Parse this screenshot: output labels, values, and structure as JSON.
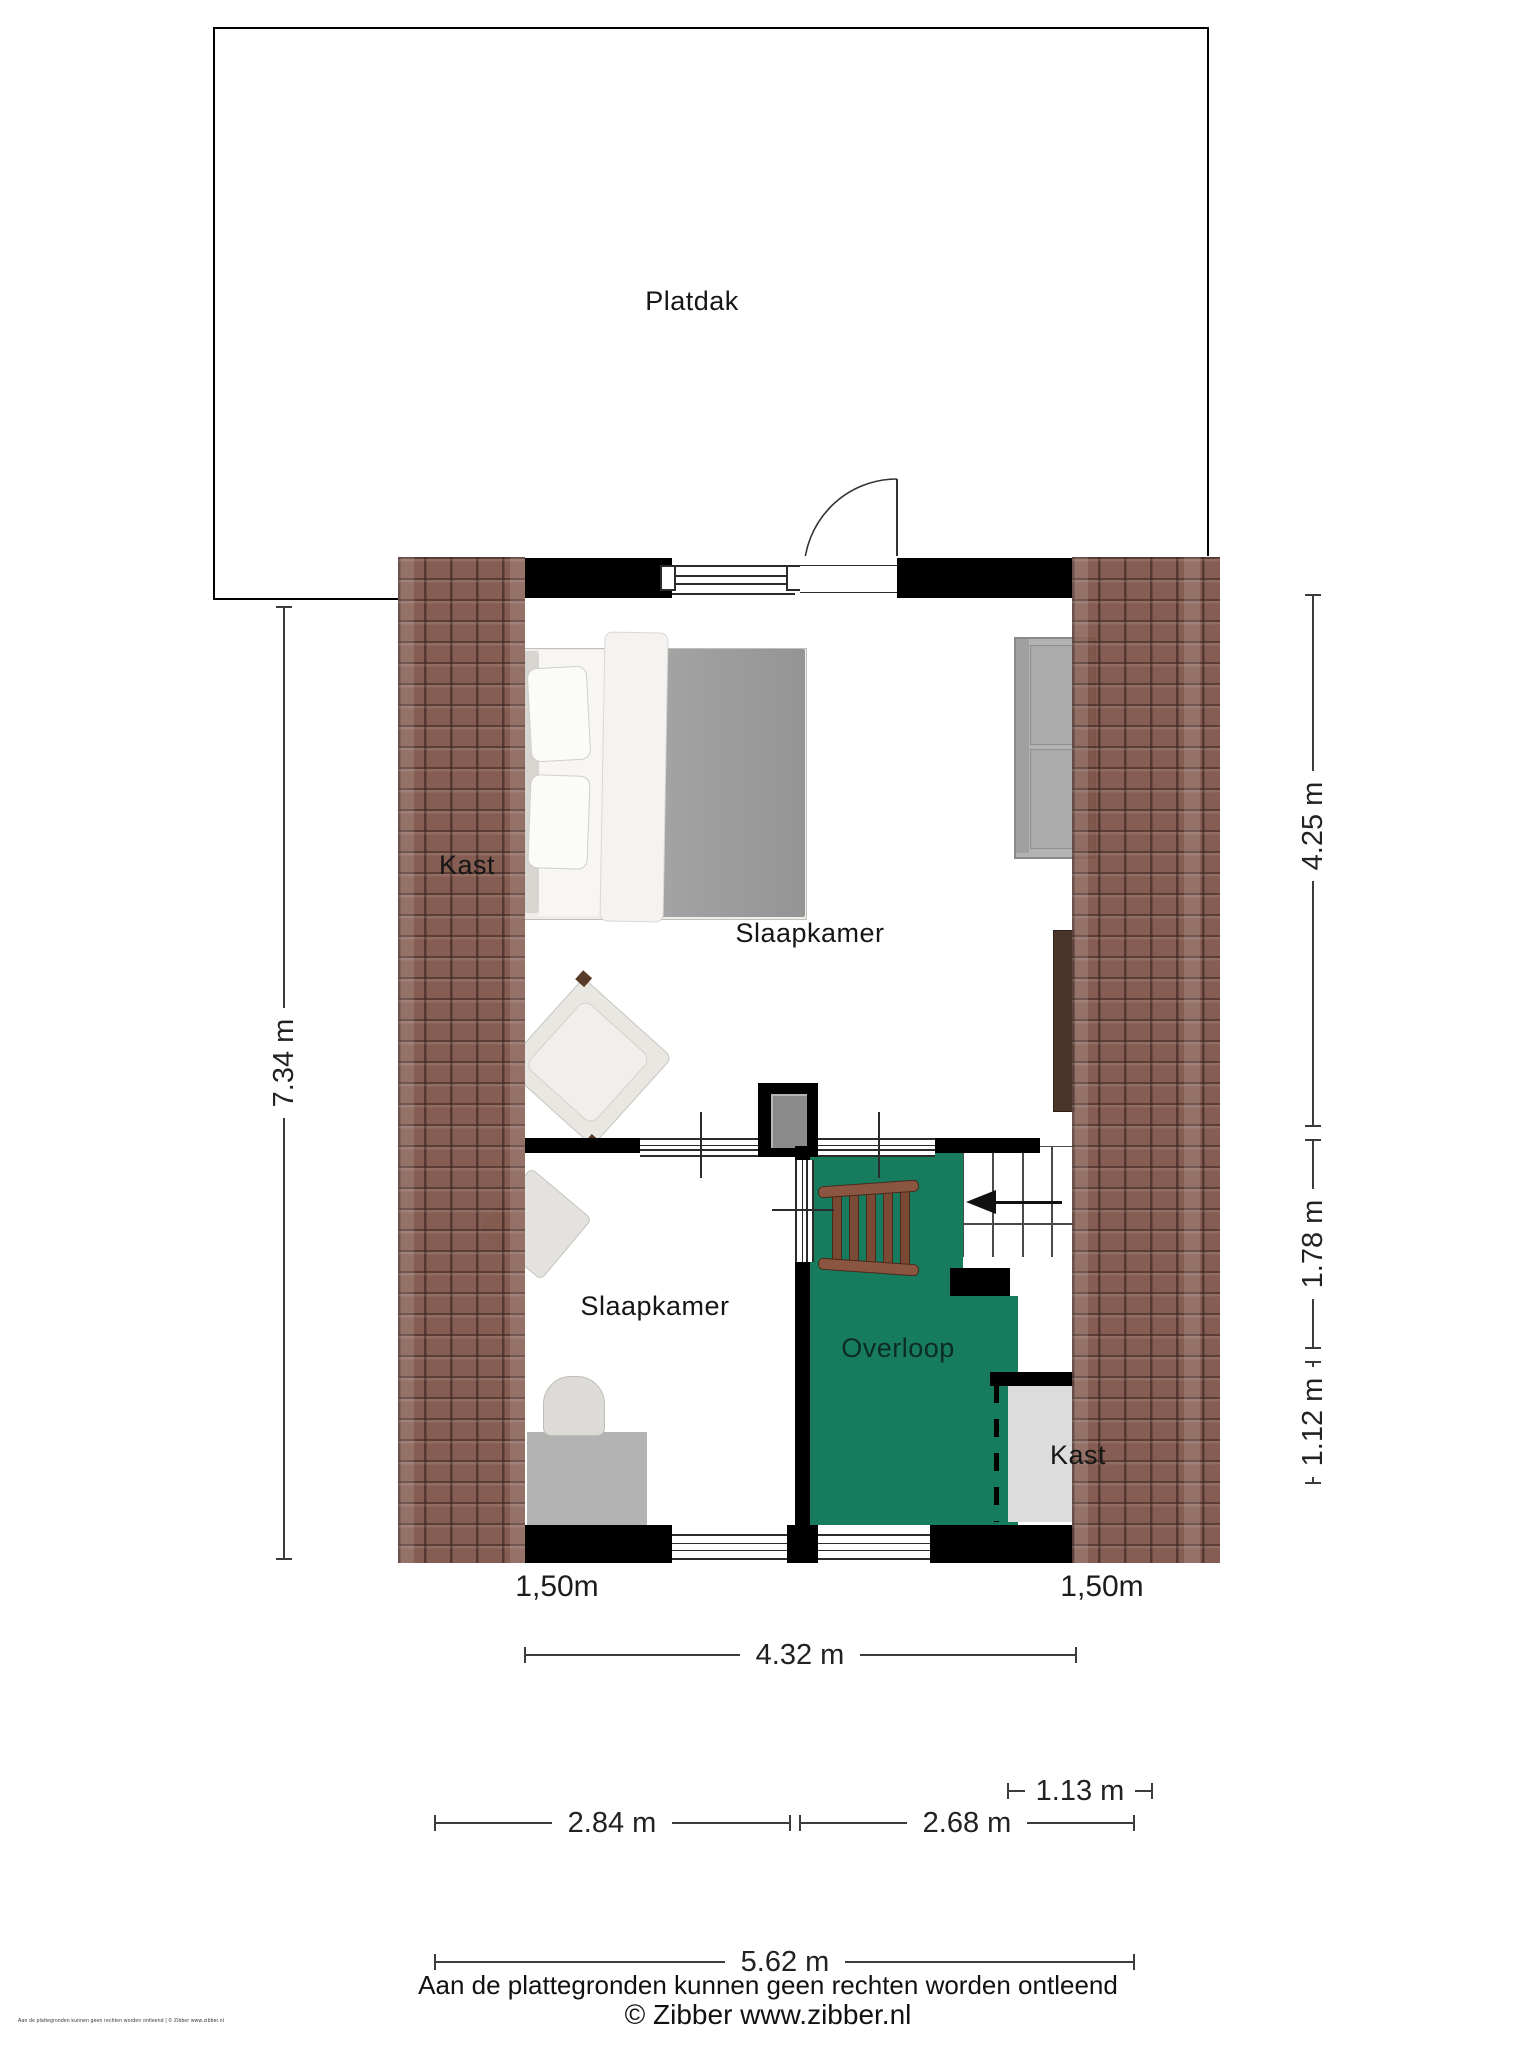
{
  "rooms": {
    "platdak": "Platdak",
    "slaapkamer_top": "Slaapkamer",
    "slaapkamer_bottom": "Slaapkamer",
    "overloop": "Overloop",
    "kast_left": "Kast",
    "kast_right": "Kast"
  },
  "dims": {
    "total_height": "7.34 m",
    "upper_height": "4.25 m",
    "middle_height": "1.78 m",
    "lower_height": "1.12 m",
    "knee_left": "1,50m",
    "knee_right": "1,50m",
    "inner_width": "4.32 m",
    "closet_width": "1.13 m",
    "room_left_width": "2.84 m",
    "room_right_width": "2.68 m",
    "total_width": "5.62 m"
  },
  "footer": {
    "disclaimer": "Aan de plattegronden kunnen geen rechten worden ontleend",
    "copyright": "© Zibber www.zibber.nl",
    "micro": "Aan de plattegronden kunnen geen rechten worden ontleend | © Zibber www.zibber.nl"
  },
  "colors": {
    "overloop_green": "#177C5E",
    "roof_tile_brown": "#7D5145",
    "wall_black": "#000000",
    "closet_gray": "#DCDCDC",
    "ladder_brown": "#7A4A35",
    "bed_duvet_gray": "#9B9B9B"
  }
}
